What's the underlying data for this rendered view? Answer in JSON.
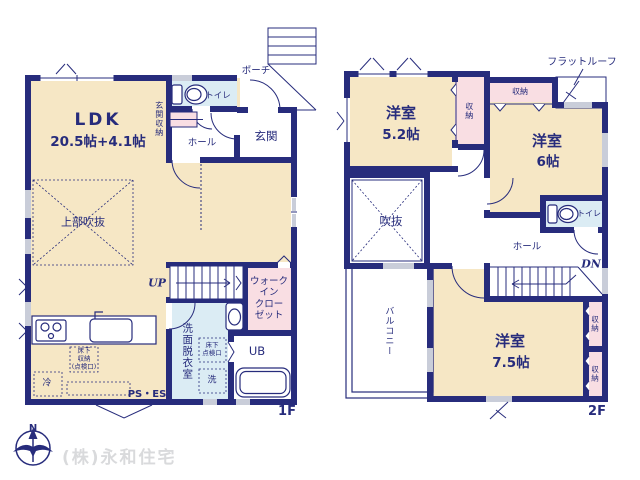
{
  "floor1": {
    "floor_label": "1F",
    "ldk": "LDK",
    "ldk_size": "20.5帖+4.1帖",
    "upper_void": "上部吹抜",
    "toilet": "トイレ",
    "entrance_storage": "玄関収納",
    "hall": "ホール",
    "entrance": "玄関",
    "porch": "ポーチ",
    "stairs_up": "UP",
    "walk_in_closet": "ウォーク\nイン\nクロー\nゼット",
    "washroom": "洗面脱衣室",
    "underfloor_access": "床下\n点検口",
    "laundry": "洗",
    "unit_bath": "UB",
    "underfloor_storage": "床下\n収納\n(点検口)",
    "fridge": "冷",
    "ps_es": "PS・ES"
  },
  "floor2": {
    "floor_label": "2F",
    "bedroom1": "洋室",
    "bedroom1_size": "5.2帖",
    "closet_side": "収納",
    "closet_top": "収納",
    "flat_roof": "フラットルーフ",
    "bedroom2": "洋室",
    "bedroom2_size": "6帖",
    "toilet": "トイレ",
    "void": "吹抜",
    "hall": "ホール",
    "stairs_down": "DN",
    "balcony": "バルコニー",
    "bedroom3": "洋室",
    "bedroom3_size": "7.5帖",
    "closet_right_upper": "収納",
    "closet_right_lower": "収納"
  },
  "footer": {
    "company": "(株)永和住宅",
    "compass_north": "N"
  },
  "colors": {
    "wall": "#272c7c",
    "room_tan": "#f6e7c5",
    "room_blue": "#dbecf4",
    "room_pink": "#f9dee3",
    "window_gray": "#c9cdd9",
    "watermark": "#d9dadc"
  }
}
